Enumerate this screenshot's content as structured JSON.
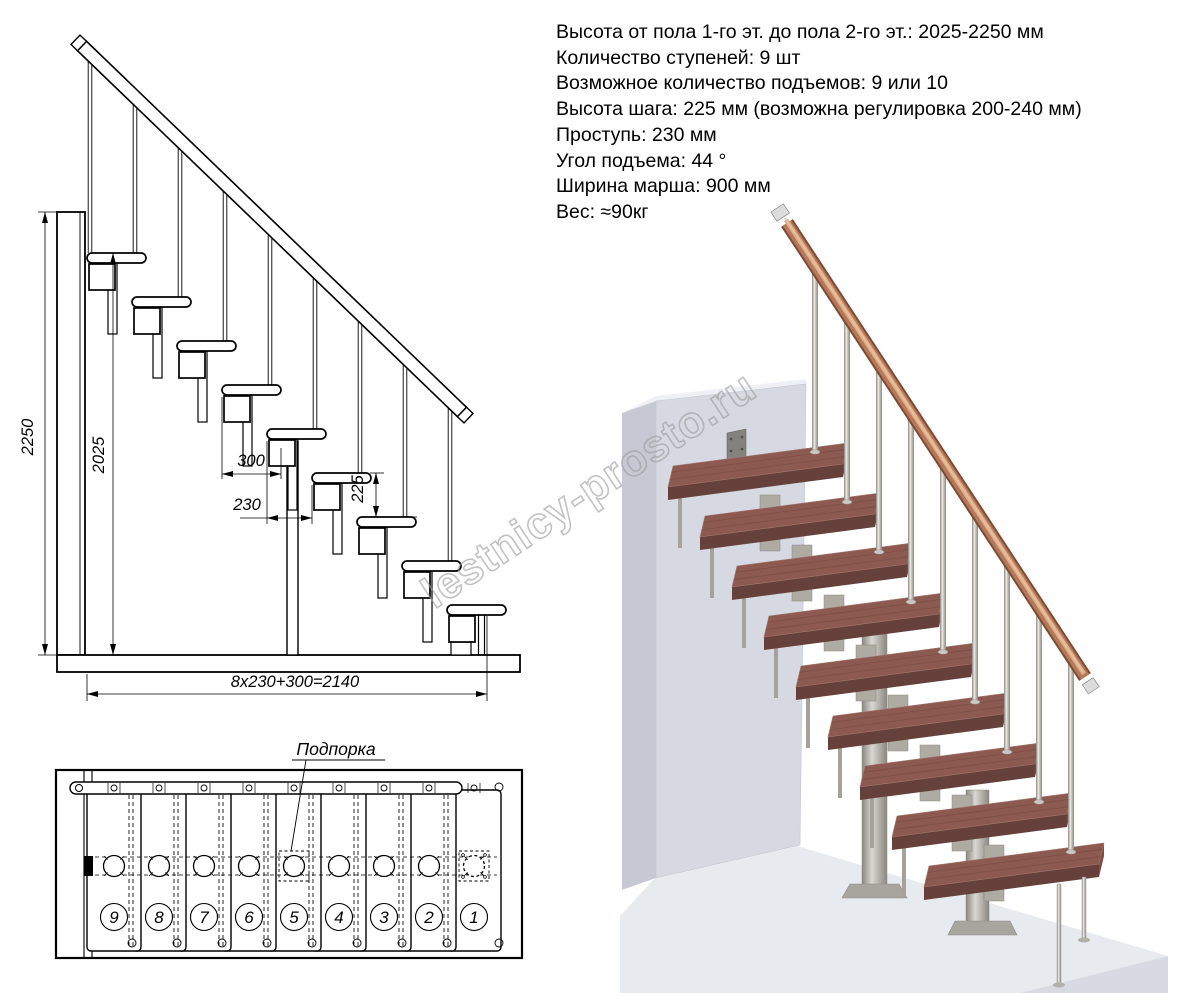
{
  "specs": {
    "lines": [
      "Высота от пола 1-го эт. до пола 2-го эт.: 2025-2250 мм",
      "Количество ступеней: 9 шт",
      "Возможное количество подъемов: 9 или 10",
      "Высота шага: 225 мм (возможна регулировка 200-240 мм)",
      "Проступь: 230 мм",
      "Угол подъема: 44 °",
      "Ширина марша: 900 мм",
      "Вес: ≈90кг"
    ]
  },
  "elevation": {
    "step_count": 9,
    "dims": {
      "total_height": "2250",
      "clear_height": "2025",
      "tread_length": "300",
      "tread_run": "230",
      "riser_height": "225",
      "total_run": "8x230+300=2140"
    }
  },
  "plan": {
    "support_label": "Подпорка",
    "step_numbers": [
      "9",
      "8",
      "7",
      "6",
      "5",
      "4",
      "3",
      "2",
      "1"
    ]
  },
  "watermark": {
    "text": "lestnicy-prosto.ru",
    "color": "#9b9b9b"
  },
  "render3d": {
    "colors": {
      "wood_top": "#8d5a51",
      "wood_front": "#66413b",
      "wood_end": "#7a4c44",
      "wall_front": "#d6d9e2",
      "wall_side": "#c6c9d3",
      "wall_top": "#eef0f6",
      "floor_top": "#e7eaef",
      "floor_front": "#d7dae2",
      "metal_light": "#e3e1db",
      "metal_mid": "#b3b0a8",
      "metal_dark": "#8d8a82",
      "plate": "#84827d",
      "rail_dark": "#7e4a34",
      "rail_mid": "#b5795a",
      "rail_light": "#ddad88",
      "rail_hl": "#e8c2a2",
      "line": "#000000"
    }
  }
}
